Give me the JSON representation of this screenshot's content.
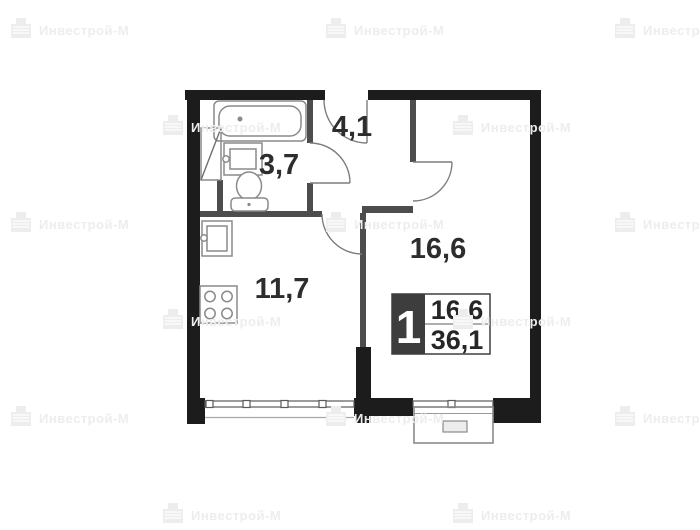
{
  "watermark": {
    "text": "Инвестрой-М",
    "icon": "developer-logo-icon",
    "color": "#ededed",
    "positions": [
      [
        8,
        16
      ],
      [
        323,
        16
      ],
      [
        612,
        16
      ],
      [
        160,
        113
      ],
      [
        450,
        113
      ],
      [
        8,
        210
      ],
      [
        323,
        210
      ],
      [
        612,
        210
      ],
      [
        160,
        307
      ],
      [
        450,
        307
      ],
      [
        8,
        404
      ],
      [
        323,
        404
      ],
      [
        612,
        404
      ],
      [
        160,
        501
      ],
      [
        450,
        501
      ]
    ]
  },
  "floor_plan": {
    "rooms": {
      "hallway": {
        "area": "4,1"
      },
      "bathroom": {
        "area": "3,7"
      },
      "kitchen": {
        "area": "11,7"
      },
      "living_room": {
        "area": "16,6"
      }
    },
    "summary_badge": {
      "rooms_count": "1",
      "living_area": "16,6",
      "total_area": "36,1"
    },
    "colors": {
      "outer_wall": "#1c1c1c",
      "interior_wall": "#4d4d4d",
      "fixture_stroke": "#8a8a8a",
      "label_text": "#2d2d2d",
      "badge_background": "#3d3d3d",
      "badge_text": "#ffffff"
    }
  }
}
